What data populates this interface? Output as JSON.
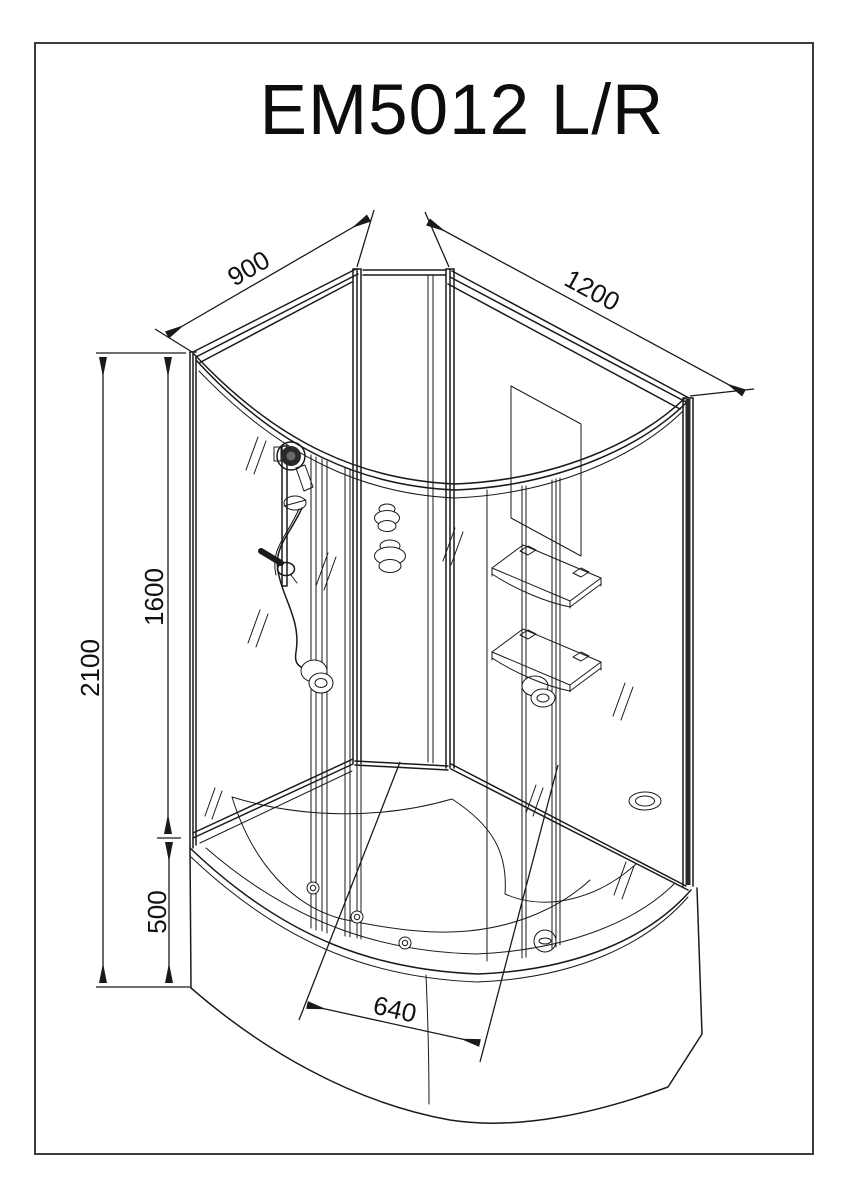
{
  "page": {
    "title": "EM5012 L/R"
  },
  "drawing": {
    "type": "technical-line-drawing",
    "subject": "offset-quadrant-shower-cabin-isometric-view",
    "orientation_note": "L/R",
    "line_color": "#1a1a1a",
    "background_color": "#ffffff",
    "dimensions": [
      {
        "id": "back-left-wall-width",
        "value": "900",
        "unit": "mm"
      },
      {
        "id": "back-right-wall-width",
        "value": "1200",
        "unit": "mm"
      },
      {
        "id": "total-height",
        "value": "2100",
        "unit": "mm"
      },
      {
        "id": "glass-section-height",
        "value": "1600",
        "unit": "mm"
      },
      {
        "id": "tray-apron-height",
        "value": "500",
        "unit": "mm"
      },
      {
        "id": "tray-inner-width",
        "value": "640",
        "unit": "mm"
      }
    ],
    "components": [
      "curved-top-track",
      "left-glass-wall",
      "right-glass-wall",
      "back-corner-panel",
      "hand-shower",
      "shower-rail",
      "shower-hose",
      "mixer-faucet",
      "body-jet-left",
      "body-jet-center-upper",
      "body-jet-center-lower",
      "body-jet-right",
      "corner-shelf-upper",
      "corner-shelf-lower",
      "mirror-panel",
      "deep-tray-with-seat",
      "drain",
      "tray-apron",
      "tray-hydro-jets"
    ]
  }
}
